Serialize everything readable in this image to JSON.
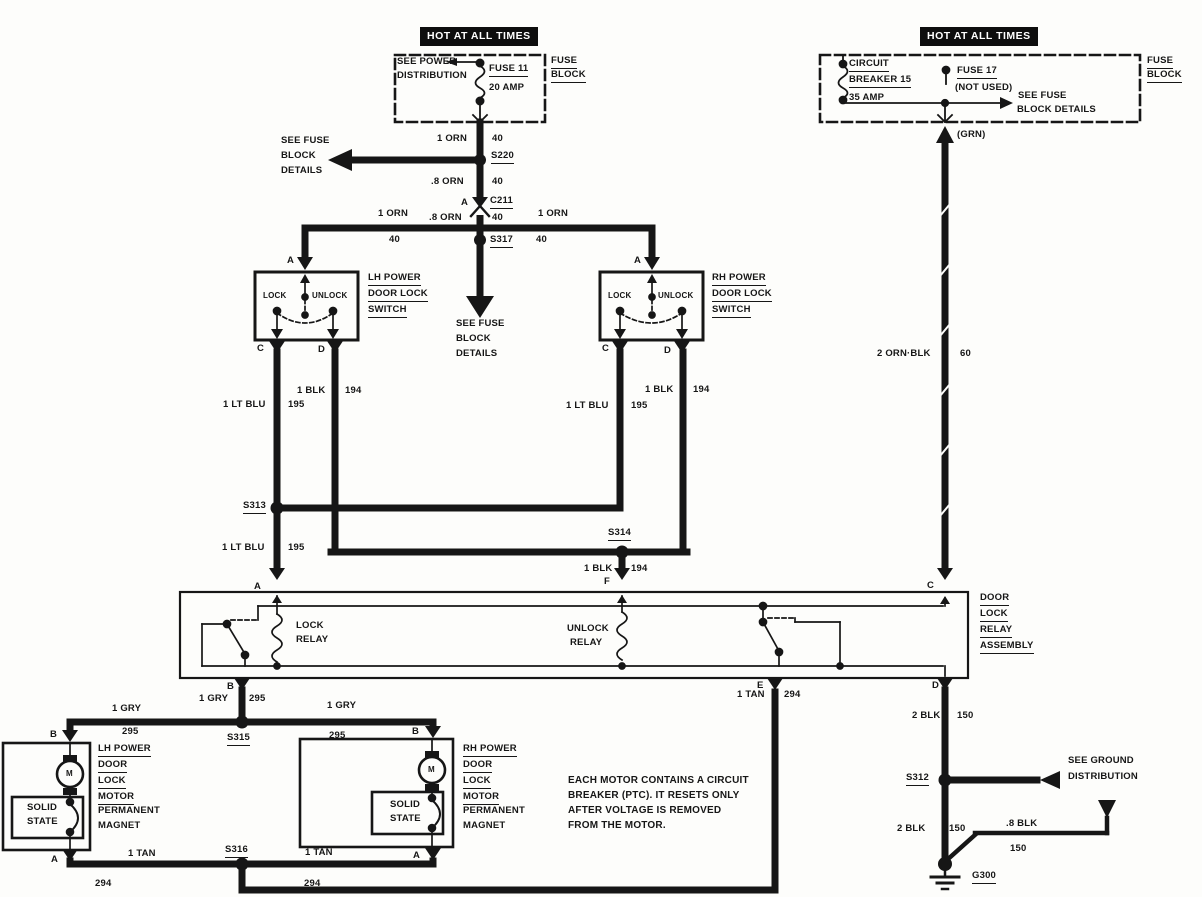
{
  "meta": {
    "ink_color": "#161616",
    "paper_color": "#fdfdfb",
    "banner_bg": "#0e0e0e"
  },
  "banners": {
    "left": "HOT AT ALL TIMES",
    "right": "HOT AT ALL TIMES"
  },
  "labels": [
    {
      "id": "see-power-distribution-line1",
      "t": "SEE POWER",
      "x": 397,
      "y": 57
    },
    {
      "id": "see-power-distribution-line2",
      "t": "DISTRIBUTION",
      "x": 397,
      "y": 71
    },
    {
      "id": "fuse-11-name",
      "t": "FUSE 11",
      "x": 489,
      "y": 64,
      "u": 1
    },
    {
      "id": "fuse-11-rating",
      "t": "20 AMP",
      "x": 489,
      "y": 83
    },
    {
      "id": "fuse-block-left-line1",
      "t": "FUSE",
      "x": 551,
      "y": 56,
      "u": 1
    },
    {
      "id": "fuse-block-left-line2",
      "t": "BLOCK",
      "x": 551,
      "y": 70,
      "u": 1
    },
    {
      "id": "wire-1orn-top",
      "t": "1 ORN",
      "x": 437,
      "y": 134
    },
    {
      "id": "wire-40-top",
      "t": "40",
      "x": 492,
      "y": 134
    },
    {
      "id": "splice-s220",
      "t": "S220",
      "x": 491,
      "y": 151,
      "u": 1
    },
    {
      "id": "wire-8orn-1",
      "t": ".8 ORN",
      "x": 431,
      "y": 177
    },
    {
      "id": "wire-40-2",
      "t": "40",
      "x": 492,
      "y": 177
    },
    {
      "id": "conn-c211-pin-a",
      "t": "A",
      "x": 461,
      "y": 198
    },
    {
      "id": "conn-c211",
      "t": "C211",
      "x": 490,
      "y": 196,
      "u": 1
    },
    {
      "id": "wire-8orn-2",
      "t": ".8 ORN",
      "x": 429,
      "y": 213
    },
    {
      "id": "wire-40-3",
      "t": "40",
      "x": 492,
      "y": 213
    },
    {
      "id": "splice-s317",
      "t": "S317",
      "x": 490,
      "y": 235,
      "u": 1
    },
    {
      "id": "see-fuse-details-left-1",
      "t": "SEE FUSE",
      "x": 281,
      "y": 136
    },
    {
      "id": "see-fuse-details-left-2",
      "t": "BLOCK",
      "x": 281,
      "y": 151
    },
    {
      "id": "see-fuse-details-left-3",
      "t": "DETAILS",
      "x": 281,
      "y": 166
    },
    {
      "id": "wire-1orn-bus-left",
      "t": "1 ORN",
      "x": 378,
      "y": 209
    },
    {
      "id": "wire-40-bus-left",
      "t": "40",
      "x": 389,
      "y": 235
    },
    {
      "id": "wire-1orn-bus-right",
      "t": "1 ORN",
      "x": 538,
      "y": 209
    },
    {
      "id": "wire-40-bus-right",
      "t": "40",
      "x": 536,
      "y": 235
    },
    {
      "id": "see-fuse-details-mid-1",
      "t": "SEE FUSE",
      "x": 456,
      "y": 319
    },
    {
      "id": "see-fuse-details-mid-2",
      "t": "BLOCK",
      "x": 456,
      "y": 334
    },
    {
      "id": "see-fuse-details-mid-3",
      "t": "DETAILS",
      "x": 456,
      "y": 349
    },
    {
      "id": "lh-switch-pin-a",
      "t": "A",
      "x": 287,
      "y": 256
    },
    {
      "id": "lh-switch-lock",
      "t": "LOCK",
      "x": 263,
      "y": 291,
      "s": 8
    },
    {
      "id": "lh-switch-unlock",
      "t": "UNLOCK",
      "x": 312,
      "y": 291,
      "s": 8
    },
    {
      "id": "lh-switch-name-1",
      "t": "LH POWER",
      "x": 368,
      "y": 273,
      "u": 1
    },
    {
      "id": "lh-switch-name-2",
      "t": "DOOR LOCK",
      "x": 368,
      "y": 289,
      "u": 1
    },
    {
      "id": "lh-switch-name-3",
      "t": "SWITCH",
      "x": 368,
      "y": 305,
      "u": 1
    },
    {
      "id": "lh-switch-pin-c",
      "t": "C",
      "x": 257,
      "y": 344
    },
    {
      "id": "lh-switch-pin-d",
      "t": "D",
      "x": 318,
      "y": 345
    },
    {
      "id": "rh-switch-pin-a",
      "t": "A",
      "x": 634,
      "y": 256
    },
    {
      "id": "rh-switch-lock",
      "t": "LOCK",
      "x": 608,
      "y": 291,
      "s": 8
    },
    {
      "id": "rh-switch-unlock",
      "t": "UNLOCK",
      "x": 658,
      "y": 291,
      "s": 8
    },
    {
      "id": "rh-switch-name-1",
      "t": "RH POWER",
      "x": 712,
      "y": 273,
      "u": 1
    },
    {
      "id": "rh-switch-name-2",
      "t": "DOOR LOCK",
      "x": 712,
      "y": 289,
      "u": 1
    },
    {
      "id": "rh-switch-name-3",
      "t": "SWITCH",
      "x": 712,
      "y": 305,
      "u": 1
    },
    {
      "id": "rh-switch-pin-c",
      "t": "C",
      "x": 602,
      "y": 344
    },
    {
      "id": "rh-switch-pin-d",
      "t": "D",
      "x": 664,
      "y": 346
    },
    {
      "id": "wire-ltblu-lh",
      "t": "1 LT BLU",
      "x": 223,
      "y": 400
    },
    {
      "id": "wire-195-lh",
      "t": "195",
      "x": 288,
      "y": 400
    },
    {
      "id": "wire-blk-lh",
      "t": "1 BLK",
      "x": 297,
      "y": 386
    },
    {
      "id": "wire-194-lh",
      "t": "194",
      "x": 345,
      "y": 386
    },
    {
      "id": "splice-s313",
      "t": "S313",
      "x": 243,
      "y": 501,
      "u": 1
    },
    {
      "id": "wire-ltblu-lh2",
      "t": "1 LT BLU",
      "x": 222,
      "y": 543
    },
    {
      "id": "wire-195-lh2",
      "t": "195",
      "x": 288,
      "y": 543
    },
    {
      "id": "wire-ltblu-rh",
      "t": "1 LT BLU",
      "x": 566,
      "y": 401
    },
    {
      "id": "wire-195-rh",
      "t": "195",
      "x": 631,
      "y": 401
    },
    {
      "id": "wire-blk-rh",
      "t": "1 BLK",
      "x": 645,
      "y": 385
    },
    {
      "id": "wire-194-rh",
      "t": "194",
      "x": 693,
      "y": 385
    },
    {
      "id": "splice-s314",
      "t": "S314",
      "x": 608,
      "y": 528,
      "u": 1
    },
    {
      "id": "wire-blk-s314",
      "t": "1 BLK",
      "x": 584,
      "y": 564
    },
    {
      "id": "wire-194-s314",
      "t": "194",
      "x": 631,
      "y": 564
    },
    {
      "id": "relay-pin-f",
      "t": "F",
      "x": 604,
      "y": 577
    },
    {
      "id": "wire-grn",
      "t": "(GRN)",
      "x": 957,
      "y": 130
    },
    {
      "id": "wire-2ornblk",
      "t": "2 ORN·BLK",
      "x": 877,
      "y": 349
    },
    {
      "id": "wire-60",
      "t": "60",
      "x": 960,
      "y": 349
    },
    {
      "id": "relay-pin-a",
      "t": "A",
      "x": 254,
      "y": 582
    },
    {
      "id": "relay-pin-c",
      "t": "C",
      "x": 927,
      "y": 581
    },
    {
      "id": "lock-relay-1",
      "t": "LOCK",
      "x": 296,
      "y": 621
    },
    {
      "id": "lock-relay-2",
      "t": "RELAY",
      "x": 296,
      "y": 635
    },
    {
      "id": "unlock-relay-1",
      "t": "UNLOCK",
      "x": 567,
      "y": 624
    },
    {
      "id": "unlock-relay-2",
      "t": "RELAY",
      "x": 570,
      "y": 638
    },
    {
      "id": "relay-assembly-1",
      "t": "DOOR",
      "x": 980,
      "y": 593,
      "u": 1
    },
    {
      "id": "relay-assembly-2",
      "t": "LOCK",
      "x": 980,
      "y": 609,
      "u": 1
    },
    {
      "id": "relay-assembly-3",
      "t": "RELAY",
      "x": 980,
      "y": 625,
      "u": 1
    },
    {
      "id": "relay-assembly-4",
      "t": "ASSEMBLY",
      "x": 980,
      "y": 641,
      "u": 1
    },
    {
      "id": "relay-pin-b",
      "t": "B",
      "x": 227,
      "y": 682
    },
    {
      "id": "relay-pin-e",
      "t": "E",
      "x": 757,
      "y": 681
    },
    {
      "id": "relay-pin-d",
      "t": "D",
      "x": 932,
      "y": 681
    },
    {
      "id": "wire-gry-b",
      "t": "1 GRY",
      "x": 199,
      "y": 694
    },
    {
      "id": "wire-295-b",
      "t": "295",
      "x": 249,
      "y": 694
    },
    {
      "id": "splice-s315",
      "t": "S315",
      "x": 227,
      "y": 733,
      "u": 1
    },
    {
      "id": "wire-gry-left",
      "t": "1 GRY",
      "x": 112,
      "y": 704
    },
    {
      "id": "wire-295-left",
      "t": "295",
      "x": 122,
      "y": 727
    },
    {
      "id": "wire-gry-right",
      "t": "1 GRY",
      "x": 327,
      "y": 701
    },
    {
      "id": "wire-295-right",
      "t": "295",
      "x": 329,
      "y": 731
    },
    {
      "id": "lh-motor-pin-b",
      "t": "B",
      "x": 50,
      "y": 730
    },
    {
      "id": "lh-motor-pin-a",
      "t": "A",
      "x": 51,
      "y": 855
    },
    {
      "id": "lh-motor-name-1",
      "t": "LH POWER",
      "x": 98,
      "y": 744,
      "u": 1
    },
    {
      "id": "lh-motor-name-2",
      "t": "DOOR",
      "x": 98,
      "y": 760,
      "u": 1
    },
    {
      "id": "lh-motor-name-3",
      "t": "LOCK",
      "x": 98,
      "y": 776,
      "u": 1
    },
    {
      "id": "lh-motor-name-4",
      "t": "MOTOR",
      "x": 98,
      "y": 792,
      "u": 1
    },
    {
      "id": "lh-motor-name-5",
      "t": "PERMANENT",
      "x": 98,
      "y": 806
    },
    {
      "id": "lh-motor-name-6",
      "t": "MAGNET",
      "x": 98,
      "y": 821
    },
    {
      "id": "lh-solid-state-1",
      "t": "SOLID",
      "x": 27,
      "y": 803
    },
    {
      "id": "lh-solid-state-2",
      "t": "STATE",
      "x": 27,
      "y": 817
    },
    {
      "id": "lh-motor-m",
      "t": "M",
      "x": 66,
      "y": 769,
      "s": 8
    },
    {
      "id": "rh-motor-pin-b",
      "t": "B",
      "x": 412,
      "y": 727
    },
    {
      "id": "rh-motor-pin-a",
      "t": "A",
      "x": 413,
      "y": 851
    },
    {
      "id": "rh-motor-name-1",
      "t": "RH POWER",
      "x": 463,
      "y": 744,
      "u": 1
    },
    {
      "id": "rh-motor-name-2",
      "t": "DOOR",
      "x": 463,
      "y": 760,
      "u": 1
    },
    {
      "id": "rh-motor-name-3",
      "t": "LOCK",
      "x": 463,
      "y": 776,
      "u": 1
    },
    {
      "id": "rh-motor-name-4",
      "t": "MOTOR",
      "x": 463,
      "y": 792,
      "u": 1
    },
    {
      "id": "rh-motor-name-5",
      "t": "PERMANENT",
      "x": 463,
      "y": 806
    },
    {
      "id": "rh-motor-name-6",
      "t": "MAGNET",
      "x": 463,
      "y": 821
    },
    {
      "id": "rh-solid-state-1",
      "t": "SOLID",
      "x": 390,
      "y": 800
    },
    {
      "id": "rh-solid-state-2",
      "t": "STATE",
      "x": 390,
      "y": 814
    },
    {
      "id": "rh-motor-m",
      "t": "M",
      "x": 428,
      "y": 765,
      "s": 8
    },
    {
      "id": "wire-tan-left",
      "t": "1 TAN",
      "x": 128,
      "y": 849
    },
    {
      "id": "wire-294-left",
      "t": "294",
      "x": 95,
      "y": 879
    },
    {
      "id": "splice-s316",
      "t": "S316",
      "x": 225,
      "y": 845,
      "u": 1
    },
    {
      "id": "wire-tan-right",
      "t": "1 TAN",
      "x": 305,
      "y": 848
    },
    {
      "id": "wire-294-right",
      "t": "294",
      "x": 304,
      "y": 879
    },
    {
      "id": "note-line1",
      "t": "EACH MOTOR CONTAINS A CIRCUIT",
      "x": 568,
      "y": 775,
      "s": 10
    },
    {
      "id": "note-line2",
      "t": "BREAKER (PTC).  IT RESETS ONLY",
      "x": 568,
      "y": 790,
      "s": 10
    },
    {
      "id": "note-line3",
      "t": "AFTER VOLTAGE IS REMOVED",
      "x": 568,
      "y": 805,
      "s": 10
    },
    {
      "id": "note-line4",
      "t": "FROM THE MOTOR.",
      "x": 568,
      "y": 820,
      "s": 10
    },
    {
      "id": "wire-tan-e",
      "t": "1 TAN",
      "x": 737,
      "y": 690
    },
    {
      "id": "wire-294-e",
      "t": "294",
      "x": 784,
      "y": 690
    },
    {
      "id": "wire-2blk-top",
      "t": "2 BLK",
      "x": 912,
      "y": 711
    },
    {
      "id": "wire-150-top",
      "t": "150",
      "x": 957,
      "y": 711
    },
    {
      "id": "splice-s312",
      "t": "S312",
      "x": 906,
      "y": 773,
      "u": 1
    },
    {
      "id": "see-ground-distribution-1",
      "t": "SEE GROUND",
      "x": 1068,
      "y": 756
    },
    {
      "id": "see-ground-distribution-2",
      "t": "DISTRIBUTION",
      "x": 1068,
      "y": 772
    },
    {
      "id": "wire-2blk-bot",
      "t": "2 BLK",
      "x": 897,
      "y": 824
    },
    {
      "id": "wire-150-bot",
      "t": "150",
      "x": 949,
      "y": 824
    },
    {
      "id": "wire-8blk",
      "t": ".8 BLK",
      "x": 1006,
      "y": 819
    },
    {
      "id": "wire-150-8blk",
      "t": "150",
      "x": 1010,
      "y": 844
    },
    {
      "id": "ground-g300",
      "t": "G300",
      "x": 972,
      "y": 871,
      "u": 1
    },
    {
      "id": "circuit-breaker-name-1",
      "t": "CIRCUIT",
      "x": 849,
      "y": 59,
      "u": 1
    },
    {
      "id": "circuit-breaker-name-2",
      "t": "BREAKER 15",
      "x": 849,
      "y": 75,
      "u": 1
    },
    {
      "id": "circuit-breaker-rating",
      "t": "35 AMP",
      "x": 849,
      "y": 93
    },
    {
      "id": "fuse-17-name",
      "t": "FUSE 17",
      "x": 957,
      "y": 66,
      "u": 1
    },
    {
      "id": "fuse-17-not-used",
      "t": "(NOT USED)",
      "x": 955,
      "y": 83
    },
    {
      "id": "see-fuse-details-right-1",
      "t": "SEE FUSE",
      "x": 1018,
      "y": 91
    },
    {
      "id": "see-fuse-details-right-2",
      "t": "BLOCK DETAILS",
      "x": 1017,
      "y": 105
    },
    {
      "id": "fuse-block-right-line1",
      "t": "FUSE",
      "x": 1147,
      "y": 56,
      "u": 1
    },
    {
      "id": "fuse-block-right-line2",
      "t": "BLOCK",
      "x": 1147,
      "y": 70,
      "u": 1
    }
  ]
}
